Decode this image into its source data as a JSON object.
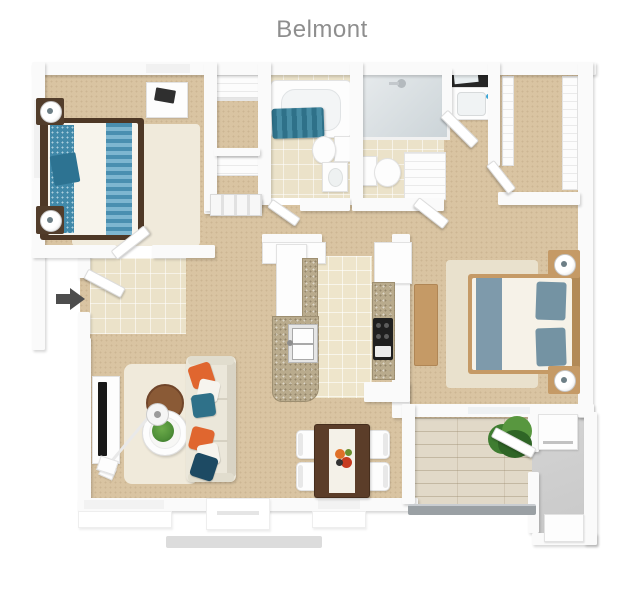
{
  "title": "Belmont",
  "entry_arrow": {
    "direction": "right"
  },
  "colors": {
    "title_text": "#8e8e8e",
    "wall": "#fafafa",
    "carpet": "#d9c4a2",
    "tile": "#ebe2c9",
    "kitchen_tile": "#eee5cb",
    "deck": "#e1d9c8",
    "concrete": "#c9c9c9",
    "rug_cream": "#f0eadb",
    "rug_light": "#e9e1cd",
    "teal_bedding": "#4189a9",
    "teal_dark": "#2d7392",
    "bed_frame_dark": "#4e3826",
    "wood_dark": "#523d2b",
    "wood_light": "#c59a66",
    "bed2_blanket": "#7e9aab",
    "bed2_pillow": "#7493a3",
    "sofa": "#ebe7da",
    "pillow_orange": "#e0662f",
    "pillow_teal": "#2f7189",
    "pillow_navy": "#1d4a63",
    "side_table_brown": "#8a5a36",
    "dining_wood": "#5b3d29",
    "granite": "#b9ab8d",
    "stove_black": "#1f1f1f",
    "plant_green": "#4f8f38",
    "bush_green": "#3f7d31",
    "arrow_gray": "#4d4d4d",
    "rail_gray": "#9aa0a4",
    "flower_red": "#c63b20",
    "flower_orange": "#e07028",
    "mirror_black": "#262626"
  }
}
